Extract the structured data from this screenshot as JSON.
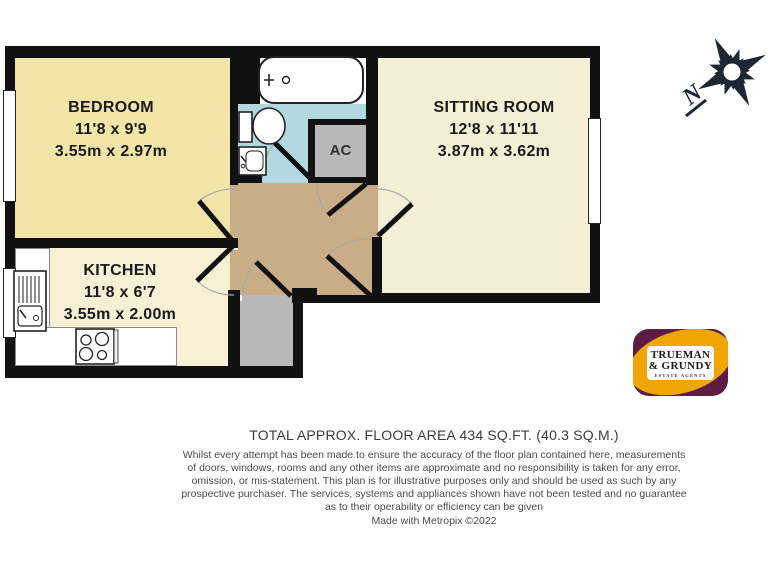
{
  "colors": {
    "wall": "#111111",
    "bedroom": "#F3E4A7",
    "kitchen": "#F7F0D5",
    "sitting_room": "#F5EFD6",
    "bathroom": "#B2D9DF",
    "hall": "#C9AD86",
    "closet": "#B8B8B8",
    "door_arc": "#A8A8A8",
    "compass": "#1C2734",
    "logo_gold": "#F0A500",
    "logo_maroon": "#5E1C44",
    "title_text": "#3C3C3C",
    "footer_text": "#4A4A4A"
  },
  "rooms": {
    "bedroom": {
      "name": "BEDROOM",
      "imperial": "11'8 x 9'9",
      "metric": "3.55m x 2.97m"
    },
    "sitting_room": {
      "name": "SITTING ROOM",
      "imperial": "12'8 x 11'11",
      "metric": "3.87m x 3.62m"
    },
    "kitchen": {
      "name": "KITCHEN",
      "imperial": "11'8 x 6'7",
      "metric": "3.55m x 2.00m"
    },
    "closet": {
      "name": "AC"
    }
  },
  "compass": {
    "label": "N"
  },
  "logo": {
    "line1": "TRUEMAN",
    "line2": "& GRUNDY",
    "tagline": "ESTATE AGENTS"
  },
  "footer": {
    "total_area": "TOTAL APPROX. FLOOR AREA 434 SQ.FT. (40.3 SQ.M.)",
    "disclaimer": "Whilst every attempt has been made to ensure the accuracy of the floor plan contained here, measurements\nof doors, windows, rooms and any other items are approximate and no responsibility is taken for any error,\nomission, or mis-statement. This plan is for illustrative purposes only and should be used as such by any\nprospective purchaser. The services, systems and appliances shown have not been tested and no guarantee\nas to their operability or efficiency can be given",
    "credit": "Made with Metropix ©2022"
  }
}
